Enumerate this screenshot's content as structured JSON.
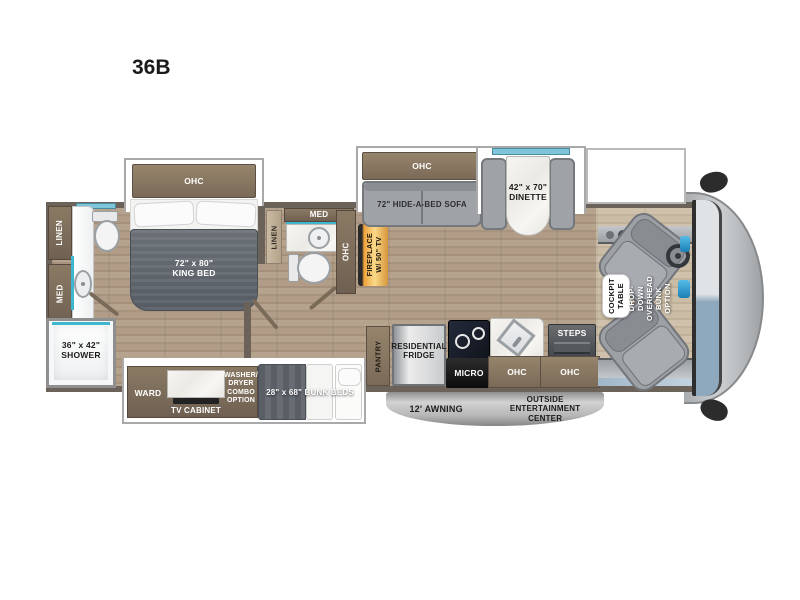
{
  "title": "36B",
  "colors": {
    "wall": "#6b635a",
    "cabinet_brown": "#75634f",
    "floor_wood": "#b29e88",
    "accent_teal": "#3fb6cf",
    "slide_outline": "#a9a9a9",
    "furniture_gray": "#9fa3a8",
    "mattress_dark": "#61666d",
    "fireplace_glow": "#f5a623",
    "awning_gray": "#b0b0b0",
    "windshield_blue": "#8ba6ba",
    "front_cap_gray": "#b7bbbd"
  },
  "labels": {
    "rear_linen": "LINEN",
    "rear_med": "MED",
    "shower": "36\" x 42\"\nSHOWER",
    "bedroom_ohc": "OHC",
    "king_bed": "72\" x 80\"\nKING BED",
    "mid_linen": "LINEN",
    "mid_med": "MED",
    "hall_ohc": "OHC",
    "fireplace": "FIREPLACE\nW/ 50\" TV",
    "sofa_ohc": "OHC",
    "sofa": "72\" HIDE-A-BED SOFA",
    "dinette": "42\" x 70\"\nDINETTE",
    "ward": "WARD",
    "tv_cabinet": "TV CABINET",
    "washer_dryer": "WASHER/\nDRYER\nCOMBO\nOPTION",
    "bunk_beds": "28\" x 68\" BUNK BEDS",
    "pantry": "PANTRY",
    "fridge": "RESIDENTIAL\nFRIDGE",
    "micro": "MICRO",
    "kitchen_ohc": "OHC",
    "steps": "STEPS",
    "entry_ohc": "OHC",
    "cockpit_table": "COCKPIT\nTABLE",
    "overhead_bunk": "DROP-DOWN\nOVERHEAD BUNK\nOPTION",
    "awning": "12' AWNING",
    "entertainment": "OUTSIDE\nENTERTAINMENT\nCENTER"
  }
}
